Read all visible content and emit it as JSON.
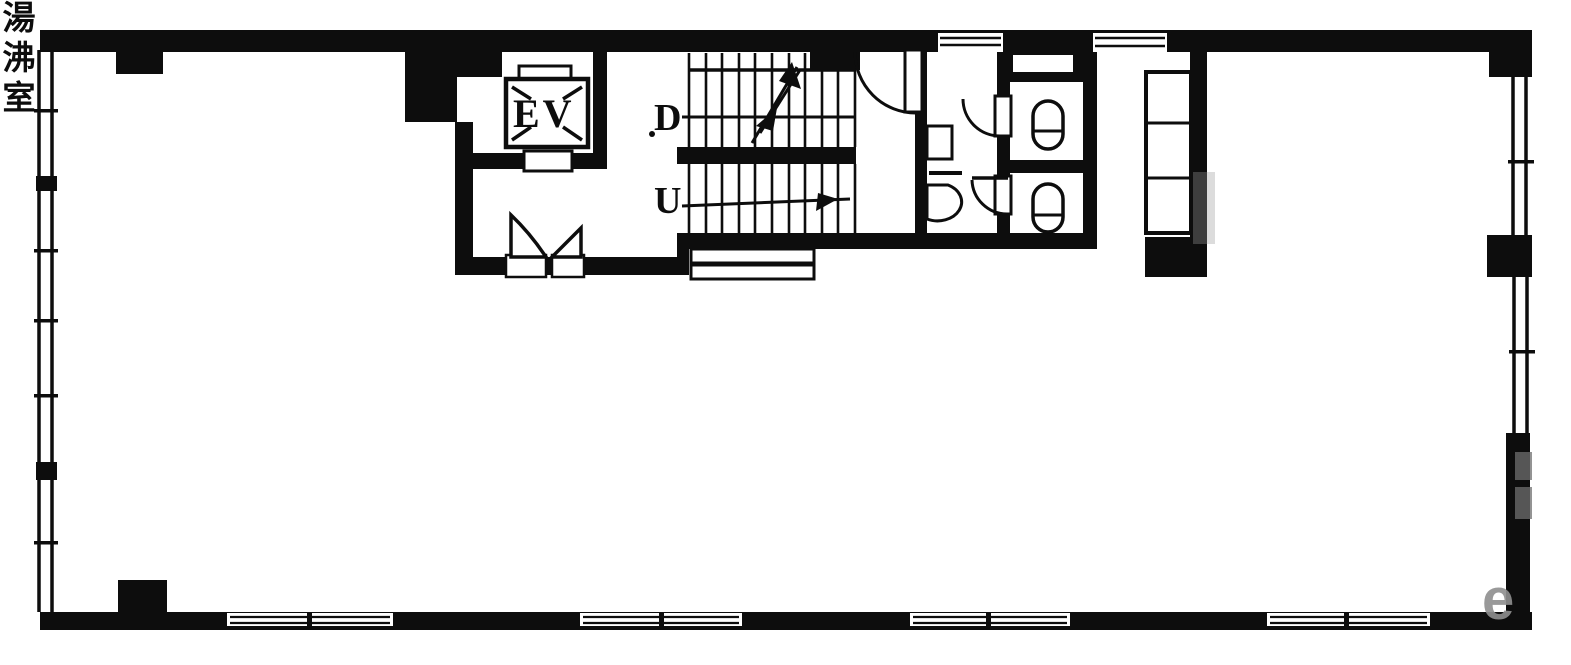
{
  "title": "building-floor-plan",
  "labels": {
    "elevator": "EV",
    "stairs_down": "D",
    "stairs_up": "U",
    "kitchenette": "湯沸室"
  },
  "watermark": {
    "letter": "e"
  },
  "colors": {
    "ink": "#0d0d0d",
    "paper": "#ffffff",
    "watermark_gray": "#8f8f8f"
  }
}
